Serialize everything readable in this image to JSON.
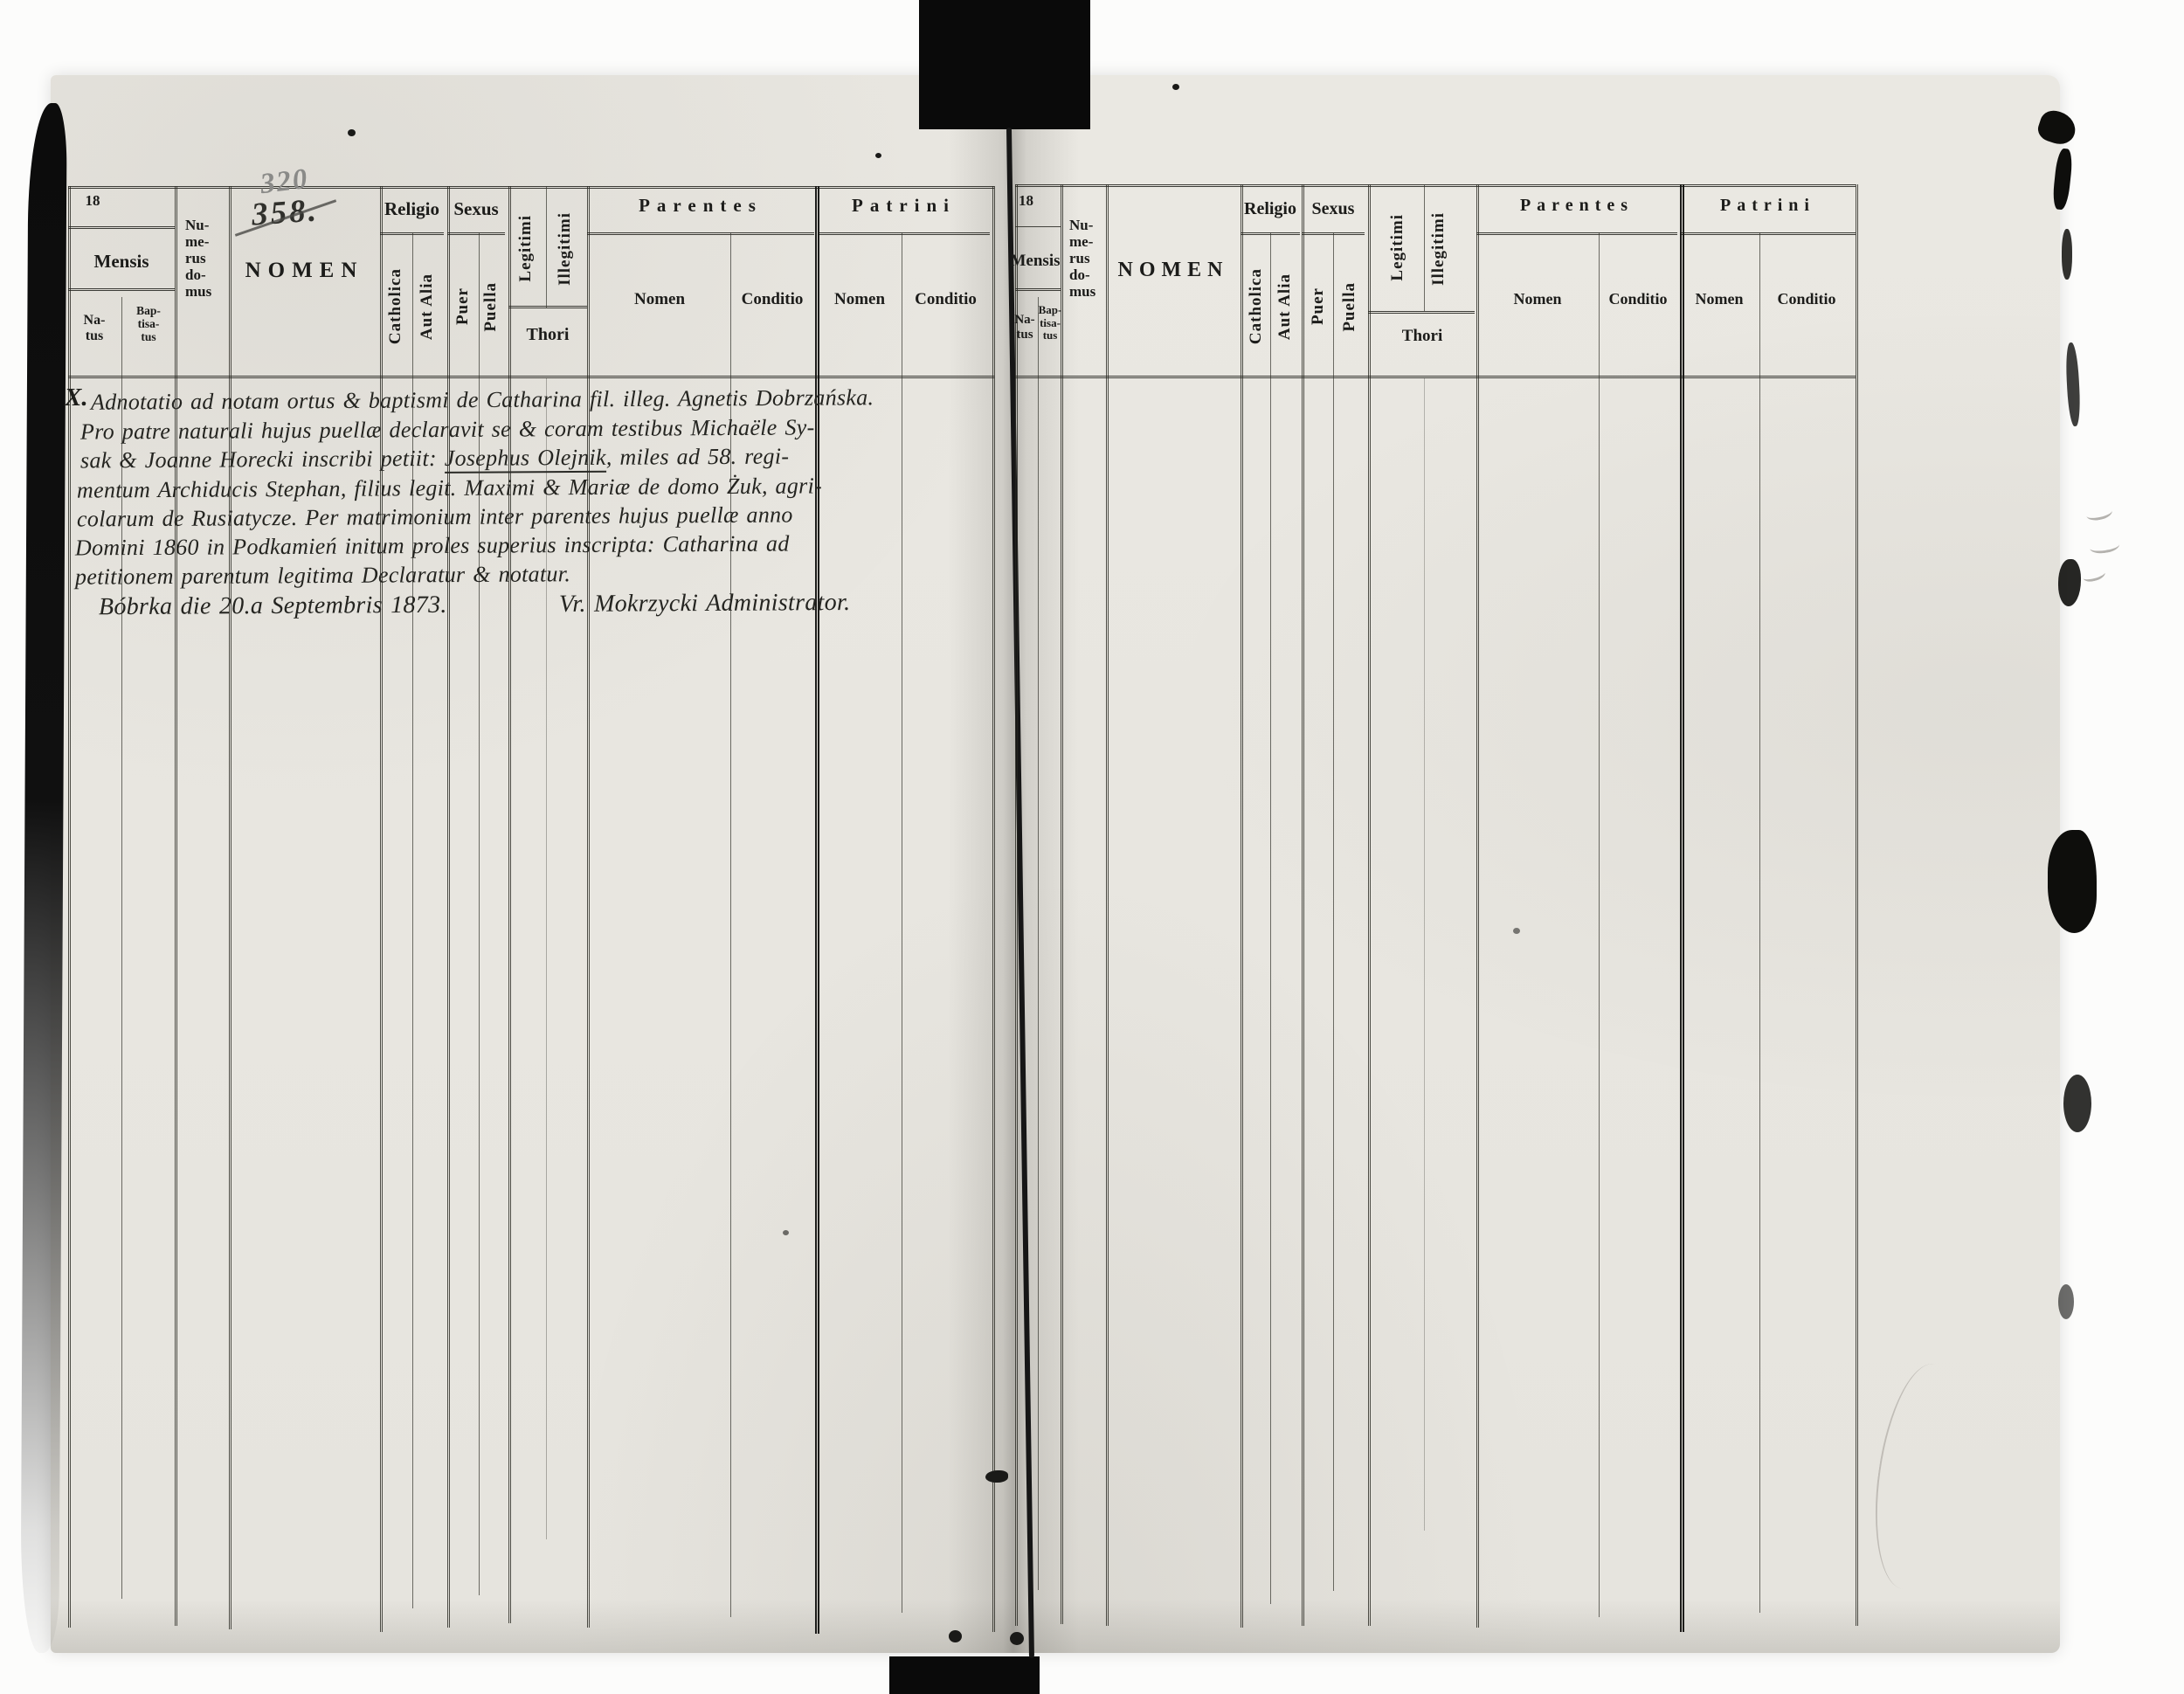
{
  "scan": {
    "colors": {
      "paper": "#eae8e2",
      "scan_background": "#fcfcfb",
      "print_ink": "#1c1c1a",
      "handwriting_ink": "#242420",
      "pencil": "#8a8a88",
      "spine_black": "#0a0a0a"
    }
  },
  "table_header": {
    "year_prefix": "18",
    "mensis": "Mensis",
    "natus": "Na-\ntus",
    "baptisatus": "Bap-\ntisa-\ntus",
    "numerus_domus": "Nu-\nme-\nrus\ndo-\nmus",
    "nomen": "NOMEN",
    "religio": "Religio",
    "catholica": "Catholica",
    "aut_alia": "Aut Alia",
    "sexus": "Sexus",
    "puer": "Puer",
    "puella": "Puella",
    "legitimi": "Legitimi",
    "illegitimi": "Illegitimi",
    "thori": "Thori",
    "parentes": "Parentes",
    "patrini": "Patrini",
    "nomen_col": "Nomen",
    "conditio_col": "Conditio"
  },
  "handwritten": {
    "page_number_new": "320",
    "page_number_old": "358.",
    "record_mark": "X.",
    "line1": "Adnotatio ad notam ortus & baptismi de Catharina fil. illeg. Agnetis Dobrzańska.",
    "line2": "Pro patre naturali hujus puellæ declaravit se & coram testibus Michaële Sy-",
    "line3_pre": "sak & Joanne Horecki inscribi petiit: ",
    "line3_name": "Josephus Olejnik",
    "line3_post": ", miles ad 58. regi-",
    "line4": "mentum Archiducis Stephan, filius legit. Maximi & Mariæ de domo Żuk, agri-",
    "line5": "colarum de Rusiatycze. Per matrimonium inter parentes hujus puellæ anno",
    "line6": "Domini 1860 in Podkamień initum proles superius inscripta: Catharina ad",
    "line7": "petitionem parentum legitima Declaratur & notatur.",
    "line8_date": "Bóbrka die 20.a Septembris 1873.",
    "line8_signature": "Vr. Mokrzycki Administrator."
  }
}
